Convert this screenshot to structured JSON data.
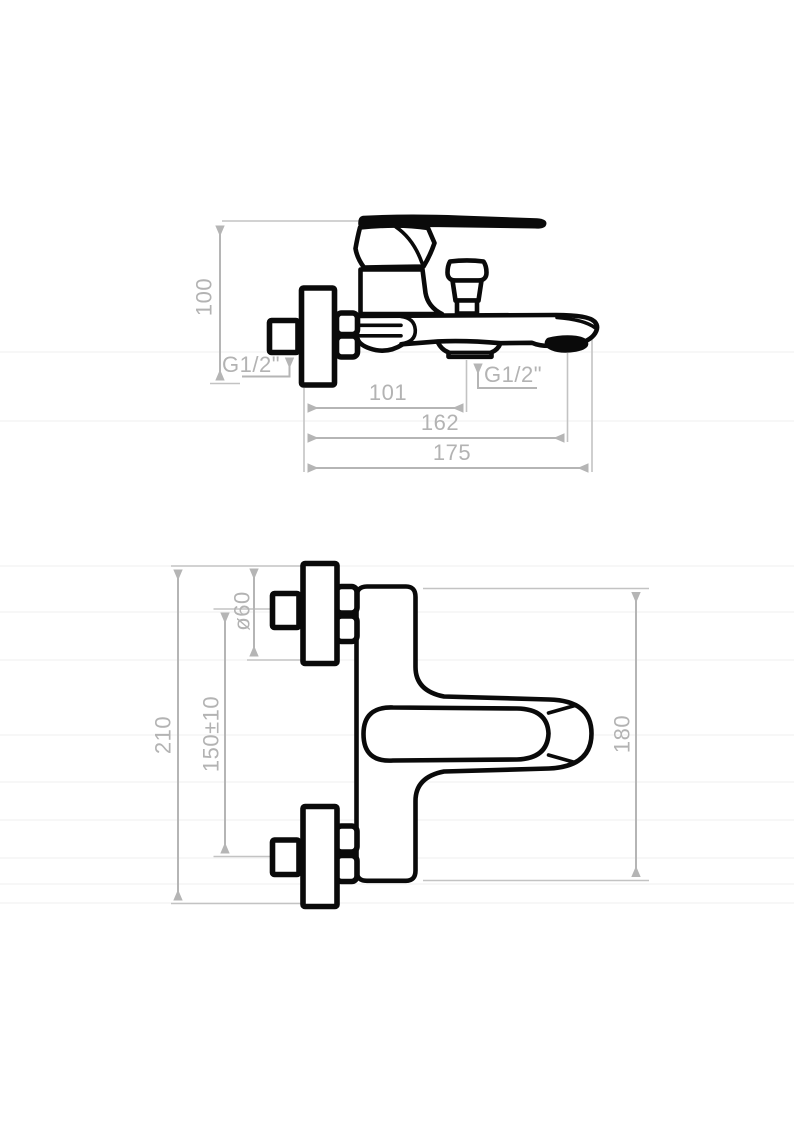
{
  "drawing": {
    "type": "technical-dimension-drawing",
    "subject": "wall-mounted bath mixer faucet, two orthographic views",
    "colors": {
      "line": "#0a0a0a",
      "dimension": "#b5b5b5",
      "background": "#ffffff"
    },
    "side_view": {
      "labels": {
        "height": "100",
        "thread_wall": "G1/2\"",
        "thread_shower": "G1/2\"",
        "wall_to_shower_outlet": "101",
        "wall_to_spout_outlet": "162",
        "total_projection": "175"
      }
    },
    "front_view": {
      "labels": {
        "total_height": "210",
        "escutcheon_diameter": "ø60",
        "connection_centers": "150±10",
        "body_height": "180"
      }
    }
  }
}
